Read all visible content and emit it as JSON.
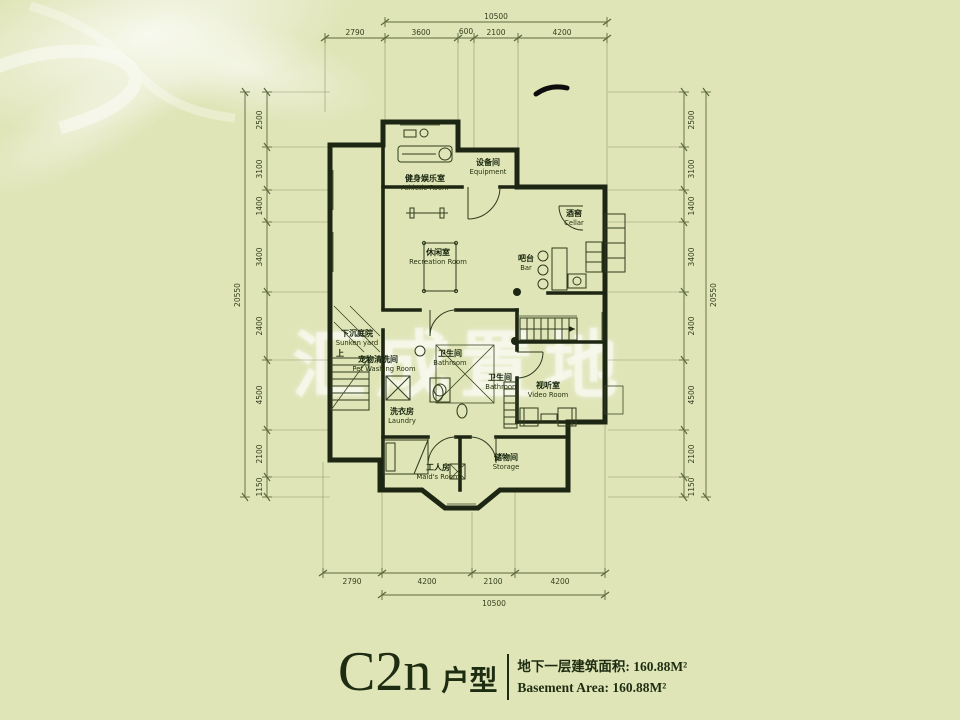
{
  "title": {
    "model": "C2n",
    "type_label": "户型",
    "area_cn": "地下一层建筑面积: 160.88M²",
    "area_en": "Basement Area: 160.88M²"
  },
  "watermark": "汇成置地",
  "rooms": {
    "equipment": {
      "cn": "设备间",
      "en": "Equipment"
    },
    "athletic": {
      "cn": "健身娱乐室",
      "en": "Athletic Room"
    },
    "recreation": {
      "cn": "休闲室",
      "en": "Recreation Room"
    },
    "cellar": {
      "cn": "酒窖",
      "en": "Cellar"
    },
    "bar": {
      "cn": "吧台",
      "en": "Bar"
    },
    "sunken_yard": {
      "cn": "下沉庭院",
      "en": "Sunken yard"
    },
    "pet_washing": {
      "cn": "宠物清洗间",
      "en": "Pet Washing Room"
    },
    "bathroom1": {
      "cn": "卫生间",
      "en": "Bathroom"
    },
    "bathroom2": {
      "cn": "卫生间",
      "en": "Bathroom"
    },
    "laundry": {
      "cn": "洗衣房",
      "en": "Laundry"
    },
    "video": {
      "cn": "视听室",
      "en": "Video Room"
    },
    "maid": {
      "cn": "工人房",
      "en": "Maid's Room"
    },
    "storage": {
      "cn": "储物间",
      "en": "Storage"
    }
  },
  "stairs": {
    "up_label": "上"
  },
  "dimensions": {
    "top": {
      "total": "10500",
      "segments": [
        "2790",
        "3600",
        "600",
        "2100",
        "4200"
      ]
    },
    "bottom": {
      "total": "10500",
      "segments": [
        "2790",
        "4200",
        "2100",
        "4200"
      ]
    },
    "left": {
      "total": "20550",
      "segments": [
        "2500",
        "3100",
        "1400",
        "3400",
        "2400",
        "4500",
        "2100",
        "1150"
      ]
    },
    "right": {
      "total": "20550",
      "segments": [
        "2500",
        "3100",
        "1400",
        "3400",
        "2400",
        "4500",
        "2100",
        "1150"
      ]
    }
  },
  "colors": {
    "background": "#e0e5b8",
    "wall": "#1d2513",
    "dim_line": "#5b673d",
    "text": "#1e2d12",
    "watermark": "#ffffff"
  }
}
